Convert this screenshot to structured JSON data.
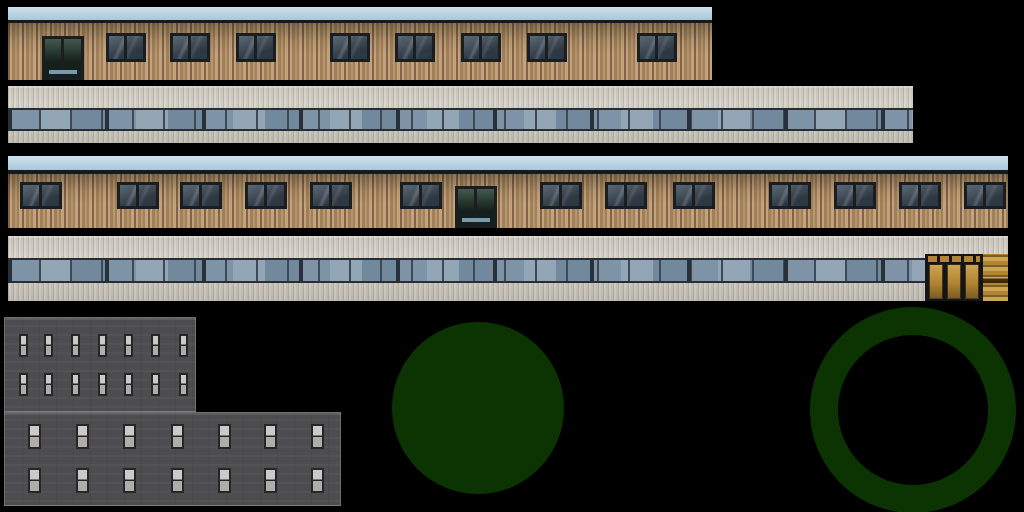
{
  "meta": {
    "kind": "building-texture-atlas",
    "canvas_width": 1024,
    "canvas_height": 512,
    "background_color": "#000000"
  },
  "palette": {
    "black": "#000000",
    "sky": "#b7d5e8",
    "eave_edge": "#17191b",
    "wood_light": "#c3a37b",
    "wood_mid": "#a08058",
    "wood_dark": "#82634a",
    "wood_warm": "#b79570",
    "frame_dark": "#1b1e21",
    "glass_high": "#5a6876",
    "glass_low": "#2e3842",
    "door_sign_blue": "#8ab0c7",
    "clad_light": "#dbd7ce",
    "clad_mid": "#d0ccc3",
    "clad_dark": "#bdb9b0",
    "pane_a": "#7e93a6",
    "pane_b": "#93a6b6",
    "pane_c": "#72889d",
    "mullion": "#3d4a55",
    "separator": "#28313a",
    "band_frame": "#262e36",
    "door_frame": "#141517",
    "gold_light": "#cda450",
    "gold_mid": "#b08433",
    "gold_dark": "#7c5d26",
    "gray_wall_a": "#4d4c4e",
    "gray_wall_b": "#535254",
    "gray_win_frame": "#262626",
    "gray_win_top": "#cbcac8",
    "gray_win_bottom": "#aeadab",
    "green": "#0c3402"
  },
  "sprites": [
    {
      "id": "strip1",
      "name": "wood-facade-upper",
      "type": "wood_facade",
      "x": 8,
      "y": 7,
      "width": 704,
      "height": 73,
      "sky_height": 13,
      "edge_height": 3,
      "windows": {
        "y": 26,
        "width": 40,
        "height": 29,
        "xs": [
          98,
          162,
          228,
          322,
          387,
          453,
          519,
          629
        ]
      },
      "door": {
        "x": 34,
        "y": 29,
        "width": 42,
        "height": 44
      }
    },
    {
      "id": "strip2",
      "name": "panel-facade-upper",
      "type": "panel_facade",
      "x": 8,
      "y": 86,
      "width": 905,
      "height": 57,
      "band": {
        "x": 0,
        "y": 22,
        "width": 905,
        "height": 23
      }
    },
    {
      "id": "strip3",
      "name": "wood-facade-lower",
      "type": "wood_facade",
      "x": 8,
      "y": 156,
      "width": 1000,
      "height": 72,
      "sky_height": 14,
      "edge_height": 4,
      "windows": {
        "y": 26,
        "width": 42,
        "height": 27,
        "xs": [
          12,
          109,
          172,
          237,
          302,
          392,
          532,
          597,
          665,
          761,
          826,
          891,
          956
        ]
      },
      "door": {
        "x": 447,
        "y": 30,
        "width": 42,
        "height": 42
      }
    },
    {
      "id": "strip4",
      "name": "panel-facade-lower",
      "type": "panel_facade",
      "x": 8,
      "y": 236,
      "width": 1000,
      "height": 65,
      "band": {
        "x": 0,
        "y": 22,
        "width": 917,
        "height": 25
      },
      "door_zone": {
        "x": 917,
        "y": 18,
        "width": 83,
        "height": 47,
        "frame_width": 58,
        "leaf_count": 3
      }
    },
    {
      "id": "gray",
      "name": "gray-building-facade",
      "type": "gray_building",
      "blocks": [
        {
          "x": 4,
          "y": 317,
          "width": 192,
          "height": 95
        },
        {
          "x": 4,
          "y": 412,
          "width": 337,
          "height": 94
        }
      ],
      "window_rows": [
        {
          "block": 0,
          "y": 16,
          "height": 23,
          "width": 9,
          "xs": [
            14,
            39,
            66,
            93,
            119,
            146,
            174
          ]
        },
        {
          "block": 0,
          "y": 55,
          "height": 23,
          "width": 9,
          "xs": [
            14,
            39,
            66,
            93,
            119,
            146,
            174
          ]
        },
        {
          "block": 1,
          "y": 11,
          "height": 25,
          "width": 13,
          "xs": [
            23,
            71,
            118,
            166,
            213,
            259,
            306
          ]
        },
        {
          "block": 1,
          "y": 55,
          "height": 25,
          "width": 13,
          "xs": [
            23,
            71,
            118,
            166,
            213,
            259,
            306
          ]
        }
      ]
    },
    {
      "id": "disc",
      "name": "green-disc",
      "type": "disc",
      "x": 392,
      "y": 322,
      "diameter": 172
    },
    {
      "id": "ring",
      "name": "green-ring",
      "type": "ring",
      "x": 810,
      "y": 307,
      "outer_diameter": 206,
      "thickness": 28
    }
  ]
}
